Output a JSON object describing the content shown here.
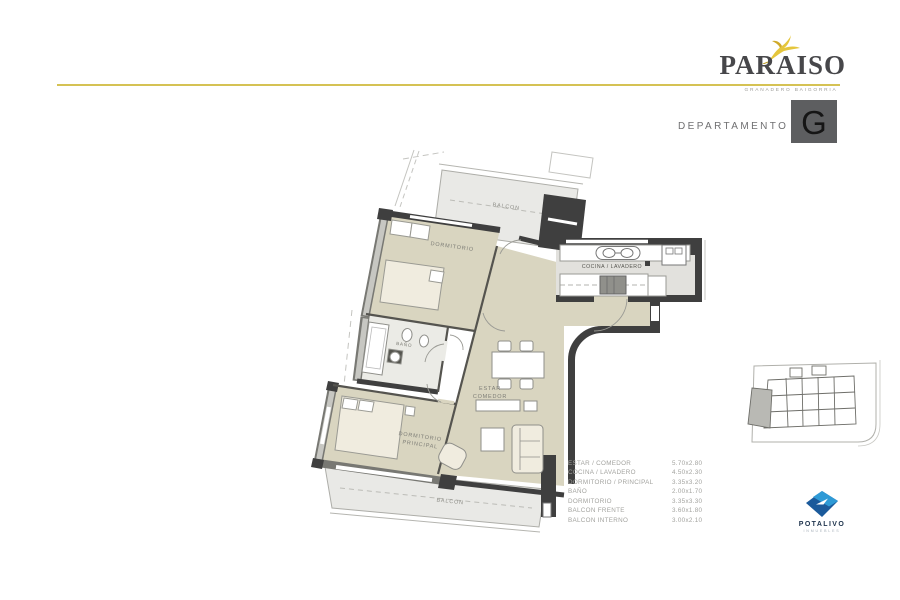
{
  "brand": {
    "name": "PARAISO",
    "subtitle": "GRANADERO BAIGORRIA",
    "accent_color": "#d5c254",
    "title_color": "#47474a"
  },
  "header": {
    "label": "DEPARTAMENTO",
    "unit": "G",
    "badge_color": "#5d5e60"
  },
  "plan": {
    "labels": {
      "balcon_top": "BALCON",
      "dormitorio": "DORMITORIO",
      "cocina": "COCINA / LAVADERO",
      "bano": "BAÑO",
      "estar_1": "ESTAR",
      "estar_2": "COMEDOR",
      "principal_1": "DORMITORIO",
      "principal_2": "PRINCIPAL",
      "balcon_bottom": "BALCON"
    },
    "colors": {
      "floor_beige": "#d9d5c0",
      "balcony_gray": "#e9e9e6",
      "wall_dark": "#3f3f3f",
      "kitchen_gray": "#e2e1dd"
    }
  },
  "legend": {
    "rows": [
      {
        "label": "ESTAR / COMEDOR",
        "size": "5.70x2.80"
      },
      {
        "label": "COCINA / LAVADERO",
        "size": "4.50x2.30"
      },
      {
        "label": "DORMITORIO / PRINCIPAL",
        "size": "3.35x3.20"
      },
      {
        "label": "BAÑO",
        "size": "2.00x1.70"
      },
      {
        "label": "DORMITORIO",
        "size": "3.35x3.30"
      },
      {
        "label": "BALCON FRENTE",
        "size": "3.60x1.80"
      },
      {
        "label": "BALCON INTERNO",
        "size": "3.00x2.10"
      }
    ]
  },
  "developer": {
    "name": "POTALIVO",
    "subtitle": "INMUEBLES",
    "blue_dark": "#1b5a9b",
    "blue_light": "#2e9ad6"
  }
}
